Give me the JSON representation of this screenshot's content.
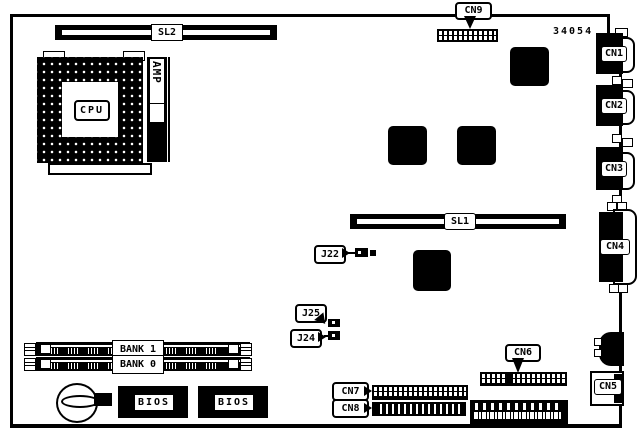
{
  "diagram": {
    "part_number": "34054",
    "slot_sl2": "SL2",
    "slot_sl1": "SL1",
    "cpu_label": "CPU",
    "amp_label": "AMP",
    "bank1_label": "BANK 1",
    "bank0_label": "BANK 0",
    "bios1_label": "BIOS",
    "bios2_label": "BIOS",
    "connectors": {
      "cn1": "CN1",
      "cn2": "CN2",
      "cn3": "CN3",
      "cn4": "CN4",
      "cn5": "CN5",
      "cn6": "CN6",
      "cn7": "CN7",
      "cn8": "CN8",
      "cn9": "CN9"
    },
    "jumpers": {
      "j22": "J22",
      "j24": "J24",
      "j25": "J25"
    },
    "colors": {
      "line": "#000000",
      "background": "#ffffff"
    }
  }
}
